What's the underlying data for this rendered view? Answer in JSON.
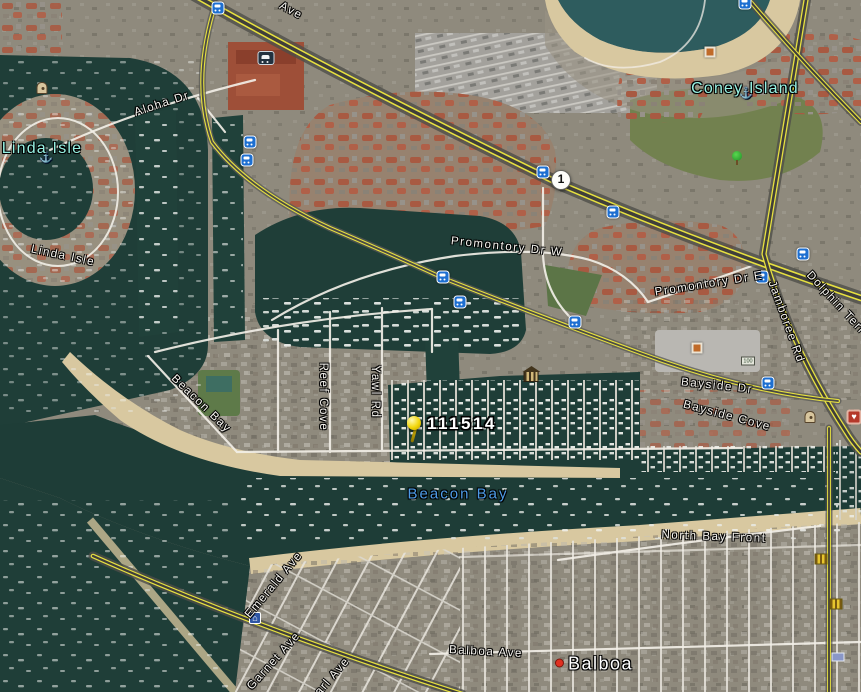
{
  "map": {
    "colors": {
      "place_label": "#97f2e3",
      "water_label": "#4d9be6",
      "street_label": "#f6f4ef",
      "road_yellow": "#e6e040",
      "transit_blue": "#1d6fd1",
      "pushpin_yellow": "#f2d60a",
      "city_dot_red": "#e03020",
      "water": "#1f3e38",
      "sand": "#d8c8a0"
    },
    "labels": [
      {
        "text": "Linda Isle",
        "kind": "place",
        "x": 42,
        "y": 149,
        "rot": 0
      },
      {
        "text": "Coney Island",
        "kind": "place",
        "x": 745,
        "y": 89,
        "rot": 0
      },
      {
        "text": "Aloha Dr",
        "kind": "street",
        "x": 162,
        "y": 104,
        "rot": -18
      },
      {
        "text": "Ave",
        "kind": "street",
        "x": 291,
        "y": 11,
        "rot": 28
      },
      {
        "text": "Linda Isle",
        "kind": "street",
        "x": 63,
        "y": 256,
        "rot": 12
      },
      {
        "text": "Promontory Dr W",
        "kind": "street",
        "x": 507,
        "y": 247,
        "rot": 6
      },
      {
        "text": "Promontory Dr E",
        "kind": "street",
        "x": 709,
        "y": 284,
        "rot": -9
      },
      {
        "text": "Jamboree Rd",
        "kind": "street",
        "x": 786,
        "y": 322,
        "rot": 70
      },
      {
        "text": "Dolphin Terr",
        "kind": "street",
        "x": 836,
        "y": 303,
        "rot": 47
      },
      {
        "text": "Bayside Dr",
        "kind": "street",
        "x": 717,
        "y": 386,
        "rot": 6
      },
      {
        "text": "Bayside Cove",
        "kind": "street",
        "x": 727,
        "y": 416,
        "rot": 15
      },
      {
        "text": "Beacon Bay",
        "kind": "street",
        "x": 201,
        "y": 404,
        "rot": 44
      },
      {
        "text": "Reef Cove",
        "kind": "street",
        "x": 323,
        "y": 397,
        "rot": 90
      },
      {
        "text": "Yawl Rd",
        "kind": "street",
        "x": 375,
        "y": 392,
        "rot": 90
      },
      {
        "text": "Beacon Bay",
        "kind": "water",
        "x": 458,
        "y": 494,
        "rot": 0
      },
      {
        "text": "North Bay Front",
        "kind": "street",
        "x": 714,
        "y": 537,
        "rot": 2
      },
      {
        "text": "Balboa Ave",
        "kind": "street",
        "x": 486,
        "y": 652,
        "rot": 3
      },
      {
        "text": "Balboa",
        "kind": "city",
        "x": 594,
        "y": 664,
        "rot": 0
      },
      {
        "text": "Emerald Ave",
        "kind": "street",
        "x": 274,
        "y": 585,
        "rot": -50
      },
      {
        "text": "Garnet Ave",
        "kind": "street",
        "x": 274,
        "y": 661,
        "rot": -48
      },
      {
        "text": "Pearl Ave",
        "kind": "street",
        "x": 327,
        "y": 683,
        "rot": -49
      }
    ],
    "marker": {
      "label": "111514",
      "label_x": 427,
      "label_y": 424,
      "pin_x": 406,
      "pin_y": 416
    },
    "icons": [
      {
        "name": "highway-shield-1",
        "kind": "shield",
        "x": 561,
        "y": 180,
        "label": "1"
      },
      {
        "name": "bus-stop-icon",
        "kind": "bus",
        "x": 218,
        "y": 8
      },
      {
        "name": "bus-stop-icon",
        "kind": "bus",
        "x": 745,
        "y": 3
      },
      {
        "name": "bus-stop-icon",
        "kind": "bus",
        "x": 250,
        "y": 142
      },
      {
        "name": "bus-stop-icon",
        "kind": "bus",
        "x": 247,
        "y": 160
      },
      {
        "name": "bus-stop-icon",
        "kind": "bus",
        "x": 543,
        "y": 172
      },
      {
        "name": "bus-stop-icon",
        "kind": "bus",
        "x": 613,
        "y": 212
      },
      {
        "name": "bus-stop-icon",
        "kind": "bus",
        "x": 443,
        "y": 277
      },
      {
        "name": "bus-stop-icon",
        "kind": "bus",
        "x": 460,
        "y": 302
      },
      {
        "name": "bus-stop-icon",
        "kind": "bus",
        "x": 575,
        "y": 322
      },
      {
        "name": "bus-stop-icon",
        "kind": "bus",
        "x": 762,
        "y": 277
      },
      {
        "name": "bus-stop-icon",
        "kind": "bus",
        "x": 803,
        "y": 254
      },
      {
        "name": "bus-stop-icon",
        "kind": "bus",
        "x": 768,
        "y": 383
      },
      {
        "name": "museum-icon",
        "kind": "museum",
        "x": 531,
        "y": 377
      },
      {
        "name": "tree-icon",
        "kind": "tree",
        "x": 737,
        "y": 158
      },
      {
        "name": "car-icon",
        "kind": "car",
        "x": 266,
        "y": 58
      },
      {
        "name": "photo-icon",
        "kind": "photo",
        "x": 710,
        "y": 52
      },
      {
        "name": "photo-icon",
        "kind": "photo",
        "x": 697,
        "y": 348
      },
      {
        "name": "banknote-icon",
        "kind": "banknote",
        "x": 748,
        "y": 361,
        "label": "100"
      },
      {
        "name": "landmark-icon",
        "kind": "landmark",
        "x": 42,
        "y": 88
      },
      {
        "name": "landmark-icon",
        "kind": "landmark",
        "x": 810,
        "y": 417
      },
      {
        "name": "heart-poi-icon",
        "kind": "heart",
        "x": 854,
        "y": 417
      },
      {
        "name": "gold-poi-icon",
        "kind": "gold",
        "x": 821,
        "y": 559
      },
      {
        "name": "gold-poi-icon",
        "kind": "gold",
        "x": 836,
        "y": 604
      },
      {
        "name": "screen-poi-icon",
        "kind": "screen",
        "x": 838,
        "y": 657
      },
      {
        "name": "house-poi-icon",
        "kind": "housepoi",
        "x": 255,
        "y": 618
      },
      {
        "name": "anchor-icon",
        "kind": "anchor",
        "x": 46,
        "y": 158
      },
      {
        "name": "anchor-icon",
        "kind": "anchor",
        "x": 746,
        "y": 94
      }
    ]
  }
}
